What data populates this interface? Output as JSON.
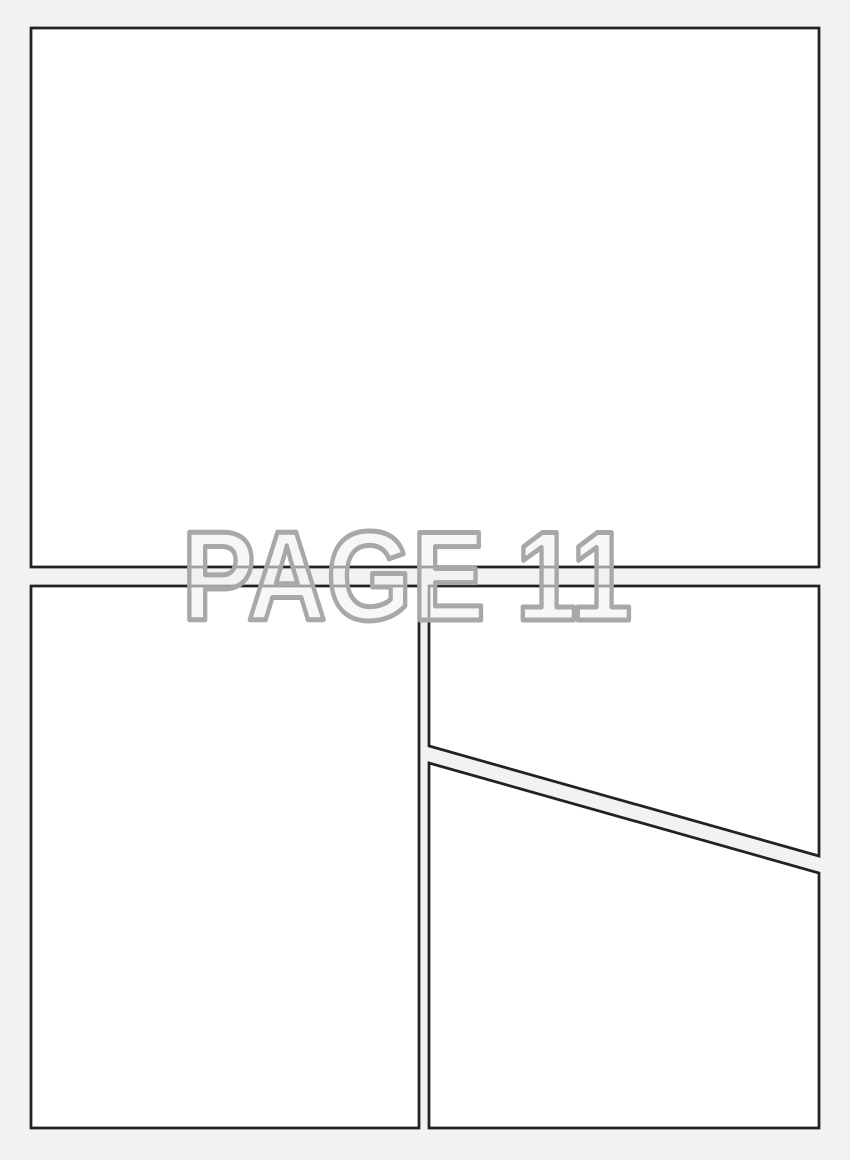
{
  "page": {
    "label": "PAGE 11",
    "colors": {
      "background": "#f2f2f2",
      "panel_fill": "#ffffff",
      "panel_border": "#222222",
      "label_outline": "#a8a8a8",
      "label_fill": "rgba(241,241,241,0.6)"
    },
    "panels": [
      {
        "name": "panel-top"
      },
      {
        "name": "panel-bottom-left"
      },
      {
        "name": "panel-top-right"
      },
      {
        "name": "panel-bottom-right"
      }
    ]
  }
}
